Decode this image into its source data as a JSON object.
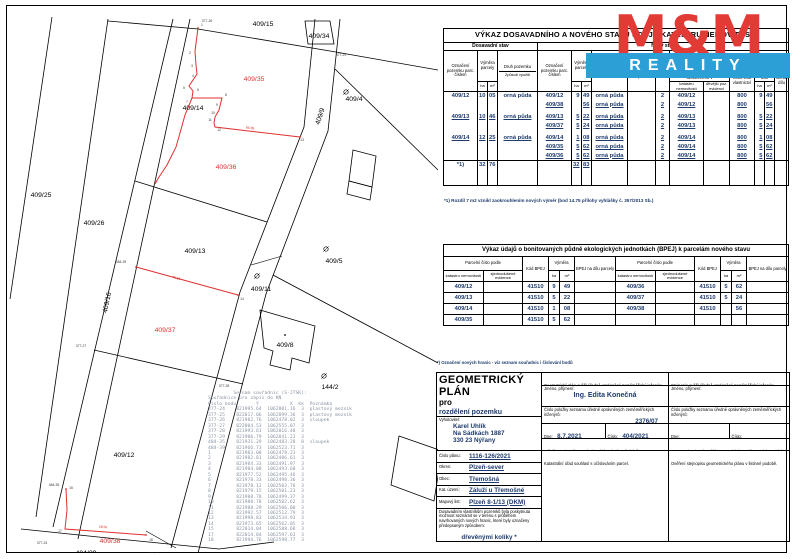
{
  "map": {
    "parcel_labels": [
      {
        "t": "409/15",
        "x": 255,
        "y": 19,
        "c": "k"
      },
      {
        "t": "409/34",
        "x": 311,
        "y": 31,
        "c": "k"
      },
      {
        "t": "409/4",
        "x": 346,
        "y": 94,
        "c": "k"
      },
      {
        "t": "409/35",
        "x": 246,
        "y": 74,
        "c": "r"
      },
      {
        "t": "409/14",
        "x": 185,
        "y": 103,
        "c": "k"
      },
      {
        "t": "409/9",
        "x": 314,
        "y": 110,
        "c": "k",
        "rot": -72
      },
      {
        "t": "409/25",
        "x": 33,
        "y": 190,
        "c": "k"
      },
      {
        "t": "409/26",
        "x": 86,
        "y": 218,
        "c": "k"
      },
      {
        "t": "409/36",
        "x": 218,
        "y": 162,
        "c": "r"
      },
      {
        "t": "409/13",
        "x": 187,
        "y": 246,
        "c": "k"
      },
      {
        "t": "409/5",
        "x": 326,
        "y": 256,
        "c": "k"
      },
      {
        "t": "409/16",
        "x": 101,
        "y": 296,
        "c": "k",
        "rot": -78
      },
      {
        "t": "409/11",
        "x": 253,
        "y": 284,
        "c": "k"
      },
      {
        "t": "409/37",
        "x": 157,
        "y": 325,
        "c": "r"
      },
      {
        "t": "409/8",
        "x": 277,
        "y": 340,
        "c": "k"
      },
      {
        "t": "144/2",
        "x": 322,
        "y": 382,
        "c": "k"
      },
      {
        "t": "409/12",
        "x": 116,
        "y": 450,
        "c": "k"
      },
      {
        "t": "409/38",
        "x": 102,
        "y": 536,
        "c": "r"
      },
      {
        "t": "404/29",
        "x": 78,
        "y": 548,
        "c": "k"
      }
    ],
    "point_labels": [
      {
        "t": "377-26",
        "x": 199,
        "y": 15
      },
      {
        "t": "377-29",
        "x": 333,
        "y": 49
      },
      {
        "t": "377-27",
        "x": 73,
        "y": 340
      },
      {
        "t": "377-28",
        "x": 216,
        "y": 380
      },
      {
        "t": "377-24",
        "x": 34,
        "y": 537
      },
      {
        "t": "377-25",
        "x": 146,
        "y": 548
      },
      {
        "t": "484-39",
        "x": 113,
        "y": 256
      },
      {
        "t": "484-35",
        "x": 46,
        "y": 479
      },
      {
        "t": "1",
        "x": 194,
        "y": 19
      },
      {
        "t": "2",
        "x": 182,
        "y": 47
      },
      {
        "t": "3",
        "x": 184,
        "y": 60
      },
      {
        "t": "4",
        "x": 185,
        "y": 70
      },
      {
        "t": "5",
        "x": 176,
        "y": 82
      },
      {
        "t": "6",
        "x": 190,
        "y": 84
      },
      {
        "t": "7",
        "x": 179,
        "y": 96
      },
      {
        "t": "8",
        "x": 218,
        "y": 89
      },
      {
        "t": "9",
        "x": 209,
        "y": 99
      },
      {
        "t": "10",
        "x": 205,
        "y": 107
      },
      {
        "t": "11",
        "x": 202,
        "y": 114
      },
      {
        "t": "12",
        "x": 211,
        "y": 124
      },
      {
        "t": "13",
        "x": 294,
        "y": 134
      },
      {
        "t": "14",
        "x": 234,
        "y": 293
      },
      {
        "t": "15",
        "x": 63,
        "y": 482
      },
      {
        "t": "17",
        "x": 52,
        "y": 525
      },
      {
        "t": "18",
        "x": 143,
        "y": 534
      }
    ],
    "dimension_labels": [
      {
        "t": "29.50",
        "x": 95,
        "y": 521,
        "rot": 3
      },
      {
        "t": "75.16",
        "x": 168,
        "y": 272,
        "rot": 15
      },
      {
        "t": "80.35",
        "x": 242,
        "y": 122,
        "rot": 6
      }
    ],
    "symbols": [
      {
        "x": 338,
        "y": 85
      },
      {
        "x": 318,
        "y": 242
      },
      {
        "x": 316,
        "y": 369
      },
      {
        "x": 249,
        "y": 269
      }
    ]
  },
  "coords_list": {
    "title": "Seznam souřadnic (S-JTSK):",
    "subtitle": "Souřadnice pro zápis do KN",
    "columns": [
      "Číslo bodu",
      "Y",
      "X",
      "kk",
      "Poznámka"
    ],
    "rows": [
      [
        "377-24",
        "821995.64",
        "1062801.16",
        "3",
        "plastový mezník"
      ],
      [
        "377-25",
        "822017.06",
        "1062899.36",
        "3",
        "plastový mezník"
      ],
      [
        "377-26",
        "821982.76",
        "1062478.02",
        "3",
        "sloupek"
      ],
      [
        "377-27",
        "822004.53",
        "1062555.07",
        "3",
        ""
      ],
      [
        "377-28",
        "821993.61",
        "1062816.48",
        "3",
        ""
      ],
      [
        "377-29",
        "821986.79",
        "1062841.23",
        "3",
        ""
      ],
      [
        "484-35",
        "821931.29",
        "1062483.28",
        "8",
        "sloupek"
      ],
      [
        "484-39",
        "821966.73",
        "1062523.71",
        "3",
        ""
      ],
      [
        "1",
        "821983.08",
        "1062478.23",
        "3",
        ""
      ],
      [
        "2",
        "821982.81",
        "1062486.61",
        "3",
        ""
      ],
      [
        "3",
        "821984.33",
        "1062491.97",
        "3",
        ""
      ],
      [
        "4",
        "821984.08",
        "1062493.60",
        "3",
        ""
      ],
      [
        "5",
        "821977.52",
        "1062495.46",
        "3",
        ""
      ],
      [
        "6",
        "821978.33",
        "1062498.36",
        "3",
        ""
      ],
      [
        "7",
        "821978.12",
        "1062503.78",
        "3",
        ""
      ],
      [
        "8",
        "821979.15",
        "1062501.23",
        "3",
        ""
      ],
      [
        "9",
        "821988.78",
        "1062499.37",
        "3",
        ""
      ],
      [
        "10",
        "821988.78",
        "1062502.62",
        "3",
        ""
      ],
      [
        "11",
        "821988.29",
        "1062506.00",
        "3",
        ""
      ],
      [
        "12",
        "821992.57",
        "1062512.79",
        "3",
        ""
      ],
      [
        "13",
        "821998.83",
        "1062534.93",
        "3",
        ""
      ],
      [
        "14",
        "821973.65",
        "1062562.05",
        "3",
        ""
      ],
      [
        "15",
        "822014.04",
        "1062588.68",
        "3",
        ""
      ],
      [
        "17",
        "822014.84",
        "1062597.63",
        "3",
        ""
      ],
      [
        "18",
        "821994.76",
        "1062598.77",
        "3",
        ""
      ]
    ]
  },
  "table1": {
    "title": "VÝKAZ DOSAVADNÍHO A NOVÉHO STAVU ÚDAJŮ KATASTRU NEMOVITOSTÍ",
    "old_state_label": "Dosavadní stav",
    "new_state_label": "Nový stav",
    "h": {
      "ozn": "Označení pozemku parc. číslem",
      "vymera": "Výměra parcely",
      "ha": "ha",
      "m2": "m²",
      "druh": "Druh pozemku",
      "zpusob": "Způsob využití",
      "typ": "Typ stavby",
      "zpusob_urceni": "Způs. určení výměr",
      "porovnani": "Porovnání se stavem evidence právních vztahů",
      "dil_prechazi": "Díl přechází z pozemku označeného v",
      "kn": "katastru nemovitostí",
      "dpe": "dřívější poz. evidenci",
      "lv": "Číslo listu vlastnictví",
      "vymera_dilu": "Výměra dílu",
      "ozn_dilu": "Označení dílu"
    },
    "rows": [
      {
        "c": [
          "409/12",
          "10",
          "05",
          "orná půda",
          "409/12",
          "9",
          "49",
          "orná půda",
          "",
          "2",
          "409/12",
          "",
          "800",
          "9",
          "49",
          ""
        ],
        "u": false
      },
      {
        "c": [
          "",
          "",
          "",
          "",
          "409/38",
          "",
          "56",
          "orná půda",
          "",
          "2",
          "409/12",
          "",
          "800",
          "",
          "56",
          ""
        ],
        "u": true
      },
      {
        "c": [
          "409/13",
          "10",
          "46",
          "orná půda",
          "409/13",
          "5",
          "22",
          "orná půda",
          "",
          "2",
          "409/13",
          "",
          "800",
          "5",
          "22",
          ""
        ],
        "u": true
      },
      {
        "c": [
          "",
          "",
          "",
          "",
          "409/37",
          "5",
          "24",
          "orná půda",
          "",
          "2",
          "409/13",
          "",
          "800",
          "5",
          "24",
          ""
        ],
        "u": true
      },
      {
        "c": [
          "409/14",
          "12",
          "25",
          "orná půda",
          "409/14",
          "1",
          "08",
          "orná půda",
          "",
          "2",
          "409/14",
          "",
          "800",
          "1",
          "08",
          ""
        ],
        "u": true
      },
      {
        "c": [
          "",
          "",
          "",
          "",
          "409/35",
          "5",
          "62",
          "orná půda",
          "",
          "2",
          "409/14",
          "",
          "800",
          "5",
          "62",
          ""
        ],
        "u": true
      },
      {
        "c": [
          "",
          "",
          "",
          "",
          "409/36",
          "5",
          "62",
          "orná půda",
          "",
          "2",
          "409/14",
          "",
          "800",
          "5",
          "62",
          ""
        ],
        "u": true
      }
    ],
    "totals": {
      "c": [
        "*1)",
        "32",
        "76",
        "",
        "",
        "32",
        "83",
        "",
        "",
        "",
        "",
        "",
        "",
        "",
        "",
        ""
      ]
    },
    "footnote": "*1) Rozdíl 7 m2 vznikl zaokrouhlením nových výměr (bod 14.75 přílohy vyhlášky č. 357/2013 Sb.)"
  },
  "logo": {
    "mm": "M&M",
    "reality": "REALITY",
    "red": "#e23b36",
    "blue": "#2b9fd6"
  },
  "table2": {
    "title": "Výkaz údajů o bonitovaných půdně ekologických jednotkách (BPEJ) k parcelám nového stavu",
    "h": {
      "parc": "Parcelní číslo podle",
      "kn": "katastru nemovitostí",
      "zje": "zjednodušené evidence",
      "kod": "Kód BPEJ",
      "vymera": "Výměra",
      "ha": "ha",
      "m2": "m²",
      "bpej_dil": "BPEJ na dílu parcely"
    },
    "rows_left": [
      [
        "409/12",
        "",
        "41510",
        "9",
        "49",
        ""
      ],
      [
        "409/13",
        "",
        "41510",
        "5",
        "22",
        ""
      ],
      [
        "409/14",
        "",
        "41510",
        "1",
        "08",
        ""
      ],
      [
        "409/35",
        "",
        "41510",
        "5",
        "62",
        ""
      ]
    ],
    "rows_right": [
      [
        "409/36",
        "",
        "41510",
        "5",
        "62",
        ""
      ],
      [
        "409/37",
        "",
        "41510",
        "5",
        "24",
        ""
      ],
      [
        "409/38",
        "",
        "41510",
        "",
        "56",
        ""
      ],
      [
        "",
        "",
        "",
        "",
        "",
        ""
      ]
    ]
  },
  "gp": {
    "note": "*) Označení nových hranic - viz seznam souřadnic i číslování bodů",
    "title": "GEOMETRICKÝ PLÁN",
    "pro": "pro",
    "purpose": "rozdělení pozemku",
    "verifier_header": "Geometrický plán ověřil úředně oprávněný zeměměřický inženýr:",
    "copy_header": "Stejnopis ověřil úředně oprávněný zeměměřický inženýr:",
    "name_label": "Jméno, příjmení:",
    "name_value": "Ing. Edita Konečná",
    "list_label": "Číslo položky seznamu úředně oprávněných zeměměřických inženýrů:",
    "list_value": "2376/07",
    "date_label": "Dne:",
    "date_value": "8.7.2021",
    "number_label": "Číslo:",
    "number_value": "404/2021",
    "compliance": "Náležitostmi a přesností odpovídá právním předpisům.",
    "copy_note": "Tento stejnopis odpovídá geometrickému plánu v elektronické podobě uloženému v dokumentaci katastrálního úřadu.",
    "ku_approval": "Katastrální úřad souhlasí s očíslováním parcel.",
    "copy_verification": "Ověření stejnopisu geometrického plánu v listinné podobě.",
    "vyhotovitel_label": "Vyhotovitel:",
    "vyhotovitel": [
      "Karel Uhlík",
      "Na Sádkách 1887",
      "330 23 Nýřany"
    ],
    "plan_no_label": "Číslo plánu:",
    "plan_no": "1116-126/2021",
    "okres_label": "Okres:",
    "okres": "Plzeň-sever",
    "obec_label": "Obec:",
    "obec": "Třemošná",
    "ku_label": "Kat. území:",
    "ku": "Záluží u Třemošné",
    "map_list_label": "Mapový list:",
    "map_list": "Plzeň 8-1/13 (DKM)",
    "notice": "Dosavadním vlastníkům pozemků byla poskytnuta možnost seznámit se v terénu s průběhem navrhovaných nových hranic, které byly označeny předepsaným způsobem:",
    "marking": "dřevěnými kolíky *"
  }
}
